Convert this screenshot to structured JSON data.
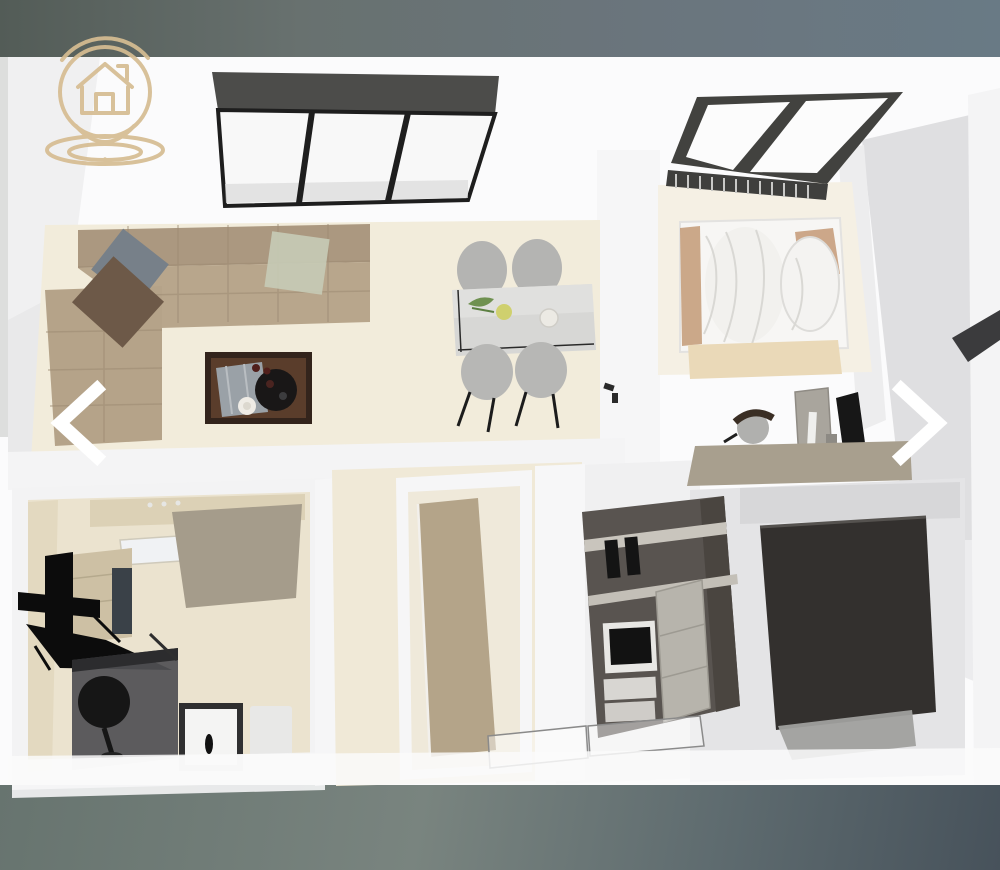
{
  "carousel": {
    "prev_icon": "chevron-left",
    "next_icon": "chevron-right",
    "icon_color": "#ffffff"
  },
  "watermark": {
    "icon": "house-location-pin-logo",
    "color": "#d6bd92"
  },
  "image": {
    "kind": "3d-floor-plan-render",
    "rooms": [
      {
        "name": "living-room",
        "objects": [
          "sectional-sofa",
          "throw-pillow-blue",
          "throw-pillow-brown",
          "throw-pillow-sage",
          "coffee-table",
          "tray",
          "blanket"
        ]
      },
      {
        "name": "dining-area",
        "objects": [
          "dining-table",
          "dining-chairs",
          "plant",
          "bowls"
        ]
      },
      {
        "name": "bedroom",
        "objects": [
          "bed",
          "pillows",
          "skylight-window",
          "radiator"
        ]
      },
      {
        "name": "office-nook",
        "objects": [
          "desk",
          "desk-chair",
          "computer-tower",
          "monitor"
        ]
      },
      {
        "name": "bathroom",
        "objects": [
          "counter",
          "sink",
          "shower-enclosure",
          "washbasin",
          "storage-box"
        ]
      },
      {
        "name": "kitchen",
        "objects": [
          "kitchen-unit",
          "oven",
          "cabinet-doors",
          "glass-railing"
        ]
      },
      {
        "name": "hallway",
        "objects": [
          "open-door"
        ]
      },
      {
        "name": "storage",
        "objects": [
          "wardrobe"
        ]
      }
    ],
    "architecture": [
      "triple-pane-window",
      "white-walls",
      "cream-flooring"
    ]
  },
  "palette": {
    "background_top": "#68717a",
    "background_bottom": "#5d6a6e",
    "photo_white": "#fbfbfc",
    "floor_cream": "#f1ead9",
    "sofa_tan": "#b5a389",
    "wood_dark": "#53382a",
    "frame_dark": "#3f3f3d",
    "wardrobe_charcoal": "#33302e"
  }
}
